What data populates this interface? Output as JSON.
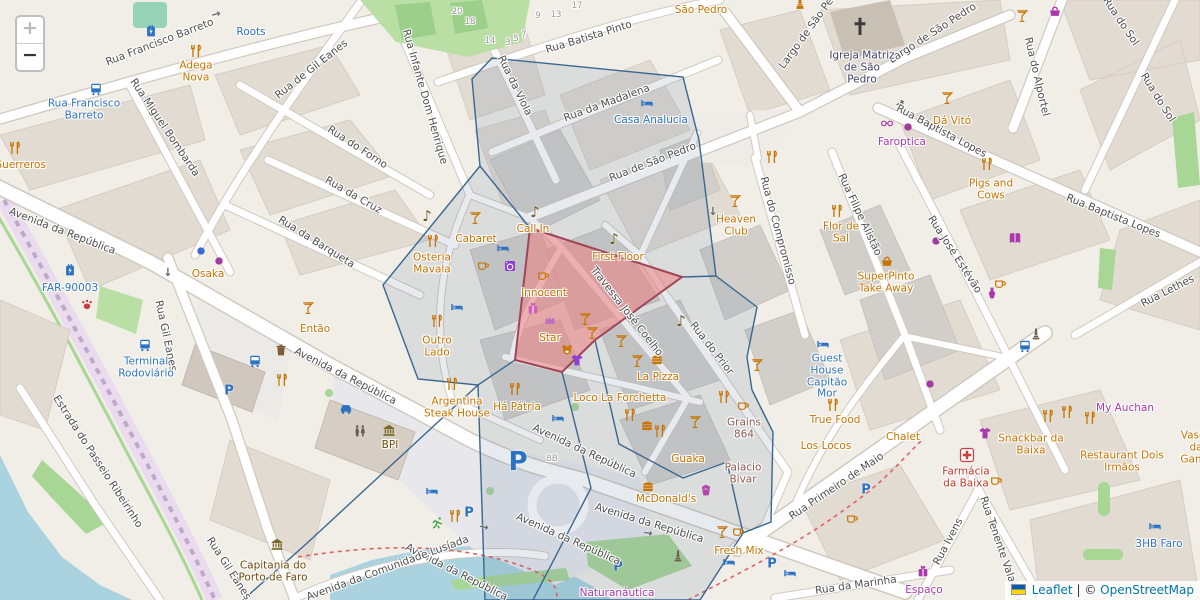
{
  "map": {
    "zoom_control": {
      "zoom_in": "+",
      "zoom_out": "−"
    },
    "attribution": {
      "leaflet_link": "Leaflet",
      "separator": "|",
      "copyright_prefix": "©",
      "osm_link": "OpenStreetMap"
    }
  },
  "palette": {
    "restaurant": "#c77400",
    "shop": "#ac39ac",
    "transit": "#3073c0",
    "brown": "#734a08",
    "historic": "#8d5b52",
    "pharmacy": "#c0392b",
    "church": "#3f3f63",
    "street": "#4e4e4e",
    "overlay_stroke": "#39678f",
    "red_zone_stroke": "#a04458",
    "water": "#aad3df"
  },
  "street_labels": [
    {
      "t": "Rua Francisco Barreto",
      "x": 160,
      "y": 43,
      "r": -21
    },
    {
      "t": "Rua Miguel Bombarda",
      "x": 164,
      "y": 128,
      "r": 56
    },
    {
      "t": "Rua Infante Dom Henrique",
      "x": 424,
      "y": 97,
      "r": 74
    },
    {
      "t": "Rua de Gil Eanes",
      "x": 312,
      "y": 70,
      "r": -38
    },
    {
      "t": "Rua do Forno",
      "x": 357,
      "y": 148,
      "r": 33
    },
    {
      "t": "Rua da Cruz",
      "x": 353,
      "y": 196,
      "r": 30
    },
    {
      "t": "Rua da Barqueta",
      "x": 316,
      "y": 243,
      "r": 32
    },
    {
      "t": "Avenida da República",
      "x": 62,
      "y": 232,
      "r": 21
    },
    {
      "t": "Rua Gil Eanes",
      "x": 165,
      "y": 336,
      "r": 78
    },
    {
      "t": "Rua Gil Eanes",
      "x": 228,
      "y": 569,
      "r": 57
    },
    {
      "t": "Estrada do Passeio Ribeirinho",
      "x": 97,
      "y": 462,
      "r": 57
    },
    {
      "t": "Rua da Viola",
      "x": 514,
      "y": 86,
      "r": 64
    },
    {
      "t": "Rua Batista Pinto",
      "x": 589,
      "y": 38,
      "r": -17
    },
    {
      "t": "Rua da Madalena",
      "x": 607,
      "y": 104,
      "r": -20
    },
    {
      "t": "Rua de São Pedro",
      "x": 653,
      "y": 163,
      "r": -21
    },
    {
      "t": "Largo de São Pedro",
      "x": 812,
      "y": 27,
      "r": -54
    },
    {
      "t": "Largo de São Pedro",
      "x": 933,
      "y": 34,
      "r": -33
    },
    {
      "t": "Rua do Alportel",
      "x": 1036,
      "y": 77,
      "r": 77
    },
    {
      "t": "Rua do Sol",
      "x": 1120,
      "y": 22,
      "r": 56
    },
    {
      "t": "Rua do Sol",
      "x": 1157,
      "y": 98,
      "r": 58
    },
    {
      "t": "Rua Baptista Lopes",
      "x": 941,
      "y": 132,
      "r": 28
    },
    {
      "t": "Rua Baptista Lopes",
      "x": 1113,
      "y": 217,
      "r": 22
    },
    {
      "t": "Rua José Estévão",
      "x": 954,
      "y": 255,
      "r": 57
    },
    {
      "t": "Rua Filipe Alistão",
      "x": 859,
      "y": 215,
      "r": 65
    },
    {
      "t": "Rua do Compromisso",
      "x": 777,
      "y": 231,
      "r": 75
    },
    {
      "t": "Rua do Prior",
      "x": 711,
      "y": 349,
      "r": 52
    },
    {
      "t": "Travessa José Coelho",
      "x": 626,
      "y": 312,
      "r": 52
    },
    {
      "t": "Rua Lethes",
      "x": 1168,
      "y": 292,
      "r": -27
    },
    {
      "t": "Avenida da República",
      "x": 345,
      "y": 377,
      "r": 27
    },
    {
      "t": "Avenida da República",
      "x": 584,
      "y": 452,
      "r": 25
    },
    {
      "t": "Avenida da República",
      "x": 568,
      "y": 540,
      "r": 24
    },
    {
      "t": "Avenida da República",
      "x": 649,
      "y": 524,
      "r": 17
    },
    {
      "t": "Avenida da República",
      "x": 456,
      "y": 573,
      "r": 27
    },
    {
      "t": "Avenida da Comunidade Lusíada",
      "x": 388,
      "y": 569,
      "r": -20
    },
    {
      "t": "Rua Primeiro de Maio",
      "x": 837,
      "y": 487,
      "r": -34
    },
    {
      "t": "Rua da Marinha",
      "x": 856,
      "y": 586,
      "r": -8
    },
    {
      "t": "Rua Ivens",
      "x": 949,
      "y": 542,
      "r": -62
    },
    {
      "t": "Rua Tenente Valadim",
      "x": 1000,
      "y": 549,
      "r": 71
    },
    {
      "t": "8B",
      "x": 552,
      "y": 459,
      "r": 0,
      "ref": true
    }
  ],
  "house_numbers": [
    {
      "t": "20",
      "x": 457,
      "y": 13
    },
    {
      "t": "18",
      "x": 470,
      "y": 23
    },
    {
      "t": "14",
      "x": 490,
      "y": 42
    },
    {
      "t": "3",
      "x": 508,
      "y": 44
    },
    {
      "t": "5",
      "x": 516,
      "y": 40
    },
    {
      "t": "7",
      "x": 524,
      "y": 36
    },
    {
      "t": "9",
      "x": 538,
      "y": 17
    },
    {
      "t": "13",
      "x": 556,
      "y": 16
    },
    {
      "t": "17",
      "x": 577,
      "y": 7
    }
  ],
  "poi_labels": [
    {
      "t": "Roots",
      "x": 251,
      "y": 33,
      "c": "transit"
    },
    {
      "t": "Adega Nova",
      "x": 196,
      "y": 72,
      "c": "restaurant",
      "w": 48
    },
    {
      "t": "Guerreros",
      "x": 20,
      "y": 166,
      "c": "restaurant"
    },
    {
      "t": "Rua Francisco Barreto",
      "x": 84,
      "y": 110,
      "c": "transit",
      "w": 90
    },
    {
      "t": "Osaka",
      "x": 208,
      "y": 275,
      "c": "restaurant"
    },
    {
      "t": "FAR-90003",
      "x": 70,
      "y": 289,
      "c": "transit"
    },
    {
      "t": "Terminal Rodoviário",
      "x": 146,
      "y": 368,
      "c": "transit",
      "w": 68
    },
    {
      "t": "Casa Analucia",
      "x": 651,
      "y": 121,
      "c": "transit"
    },
    {
      "t": "São Pedro",
      "x": 701,
      "y": 11,
      "c": "restaurant"
    },
    {
      "t": "Igreja Matriz de São Pedro",
      "x": 862,
      "y": 68,
      "c": "church",
      "w": 68
    },
    {
      "t": "Dá Vitó",
      "x": 952,
      "y": 122,
      "c": "restaurant"
    },
    {
      "t": "Faroptica",
      "x": 902,
      "y": 143,
      "c": "shop"
    },
    {
      "t": "Pigs and Cows",
      "x": 991,
      "y": 190,
      "c": "restaurant",
      "w": 60
    },
    {
      "t": "Cabaret",
      "x": 476,
      "y": 240,
      "c": "restaurant"
    },
    {
      "t": "Osteria Mavala",
      "x": 432,
      "y": 264,
      "c": "restaurant",
      "w": 54
    },
    {
      "t": "Outro Lado",
      "x": 437,
      "y": 347,
      "c": "restaurant",
      "w": 42
    },
    {
      "t": "Então",
      "x": 315,
      "y": 330,
      "c": "restaurant"
    },
    {
      "t": "Call In",
      "x": 533,
      "y": 230,
      "c": "restaurant"
    },
    {
      "t": "First Floor",
      "x": 618,
      "y": 258,
      "c": "restaurant"
    },
    {
      "t": "Innocent",
      "x": 544,
      "y": 294,
      "c": "restaurant"
    },
    {
      "t": "Star",
      "x": 550,
      "y": 339,
      "c": "restaurant"
    },
    {
      "t": "Heaven Club",
      "x": 736,
      "y": 226,
      "c": "restaurant",
      "w": 50
    },
    {
      "t": "Flor de Sal",
      "x": 841,
      "y": 233,
      "c": "restaurant",
      "w": 42
    },
    {
      "t": "SuperPinto Take Away",
      "x": 886,
      "y": 283,
      "c": "restaurant",
      "w": 82
    },
    {
      "t": "Guest House Capitão Mor",
      "x": 827,
      "y": 377,
      "c": "transit",
      "w": 56
    },
    {
      "t": "La Pizza",
      "x": 658,
      "y": 378,
      "c": "restaurant"
    },
    {
      "t": "Loco La Forchetta",
      "x": 620,
      "y": 399,
      "c": "restaurant"
    },
    {
      "t": "Há Pátria",
      "x": 517,
      "y": 408,
      "c": "restaurant"
    },
    {
      "t": "Argentina Steak House",
      "x": 457,
      "y": 408,
      "c": "restaurant",
      "w": 80
    },
    {
      "t": "True Food",
      "x": 835,
      "y": 421,
      "c": "restaurant"
    },
    {
      "t": "Los Locos",
      "x": 826,
      "y": 447,
      "c": "restaurant"
    },
    {
      "t": "Chalet",
      "x": 903,
      "y": 438,
      "c": "restaurant"
    },
    {
      "t": "Grains 864",
      "x": 744,
      "y": 429,
      "c": "historic",
      "w": 44
    },
    {
      "t": "Guaka",
      "x": 688,
      "y": 460,
      "c": "restaurant"
    },
    {
      "t": "Palacio Bivar",
      "x": 743,
      "y": 474,
      "c": "historic",
      "w": 52
    },
    {
      "t": "McDonald's",
      "x": 666,
      "y": 500,
      "c": "restaurant"
    },
    {
      "t": "Fresh Mix",
      "x": 739,
      "y": 552,
      "c": "restaurant"
    },
    {
      "t": "BPI",
      "x": 390,
      "y": 446,
      "c": "brown"
    },
    {
      "t": "Capitania do Porto de Faro",
      "x": 273,
      "y": 572,
      "c": "brown",
      "w": 74
    },
    {
      "t": "Naturanáutica",
      "x": 617,
      "y": 594,
      "c": "shop"
    },
    {
      "t": "My Auchan",
      "x": 1125,
      "y": 409,
      "c": "shop"
    },
    {
      "t": "Snackbar da Baixa",
      "x": 1031,
      "y": 445,
      "c": "restaurant",
      "w": 68
    },
    {
      "t": "Restaurant Dois Irmãos",
      "x": 1122,
      "y": 462,
      "c": "restaurant",
      "w": 105
    },
    {
      "t": "Farmácia da Baixa",
      "x": 966,
      "y": 478,
      "c": "pharmacy",
      "w": 62
    },
    {
      "t": "Espaço",
      "x": 924,
      "y": 591,
      "c": "shop"
    },
    {
      "t": "Vasco da Gama",
      "x": 1196,
      "y": 448,
      "c": "restaurant",
      "w": 46
    },
    {
      "t": "3HB Faro",
      "x": 1159,
      "y": 545,
      "c": "transit"
    }
  ],
  "icons": [
    {
      "k": "charge",
      "x": 151,
      "y": 32,
      "c": "#2b72c2"
    },
    {
      "k": "charge",
      "x": 70,
      "y": 271,
      "c": "#2b72c2"
    },
    {
      "k": "bus",
      "x": 96,
      "y": 90,
      "c": "#2b72c2"
    },
    {
      "k": "bus",
      "x": 145,
      "y": 346,
      "c": "#2b72c2"
    },
    {
      "k": "bus",
      "x": 255,
      "y": 362,
      "c": "#2b72c2"
    },
    {
      "k": "bus",
      "x": 1025,
      "y": 347,
      "c": "#2b72c2"
    },
    {
      "k": "pletter",
      "x": 229,
      "y": 391,
      "c": "#2b72c2"
    },
    {
      "k": "pletter",
      "x": 518,
      "y": 462,
      "c": "#2b72c2",
      "s": 26
    },
    {
      "k": "pletter",
      "x": 618,
      "y": 567,
      "c": "#2b72c2"
    },
    {
      "k": "pletter",
      "x": 772,
      "y": 564,
      "c": "#2b72c2"
    },
    {
      "k": "pletter",
      "x": 866,
      "y": 490,
      "c": "#2b72c2"
    },
    {
      "k": "pletter",
      "x": 469,
      "y": 513,
      "c": "#2b72c2"
    },
    {
      "k": "car",
      "x": 346,
      "y": 410,
      "c": "#2b72c2"
    },
    {
      "k": "paw",
      "x": 87,
      "y": 306,
      "c": "#cc3b3b"
    },
    {
      "k": "cross",
      "x": 860,
      "y": 28,
      "c": "#3a3a3a",
      "s": 18
    },
    {
      "k": "pharm",
      "x": 967,
      "y": 457,
      "c": "#d33d3d",
      "s": 15
    },
    {
      "k": "statue",
      "x": 800,
      "y": 4,
      "c": "#c77400"
    },
    {
      "k": "monument",
      "x": 1036,
      "y": 335,
      "c": "#6e5f4e"
    },
    {
      "k": "monument",
      "x": 678,
      "y": 557,
      "c": "#6e5f4e"
    },
    {
      "k": "bank",
      "x": 389,
      "y": 431,
      "c": "#7a6a28"
    },
    {
      "k": "bank",
      "x": 277,
      "y": 545,
      "c": "#7a6a28"
    },
    {
      "k": "toilet",
      "x": 360,
      "y": 432,
      "c": "#6b5d4f"
    },
    {
      "k": "trash",
      "x": 281,
      "y": 351,
      "c": "#7a5b3a"
    },
    {
      "k": "runner",
      "x": 438,
      "y": 524,
      "c": "#3aa33a"
    },
    {
      "k": "fork",
      "x": 196,
      "y": 52
    },
    {
      "k": "fork",
      "x": 15,
      "y": 149
    },
    {
      "k": "fork",
      "x": 433,
      "y": 242
    },
    {
      "k": "fork",
      "x": 437,
      "y": 322
    },
    {
      "k": "fork",
      "x": 515,
      "y": 390
    },
    {
      "k": "fork",
      "x": 837,
      "y": 212
    },
    {
      "k": "fork",
      "x": 987,
      "y": 165
    },
    {
      "k": "fork",
      "x": 833,
      "y": 406
    },
    {
      "k": "fork",
      "x": 772,
      "y": 158
    },
    {
      "k": "fork",
      "x": 724,
      "y": 398
    },
    {
      "k": "fork",
      "x": 660,
      "y": 432
    },
    {
      "k": "fork",
      "x": 1048,
      "y": 417
    },
    {
      "k": "fork",
      "x": 1067,
      "y": 413
    },
    {
      "k": "fork",
      "x": 1090,
      "y": 419
    },
    {
      "k": "fork",
      "x": 455,
      "y": 517
    },
    {
      "k": "fork",
      "x": 452,
      "y": 385
    },
    {
      "k": "fork",
      "x": 282,
      "y": 381
    },
    {
      "k": "fork",
      "x": 630,
      "y": 416
    },
    {
      "k": "cocktail",
      "x": 475,
      "y": 219
    },
    {
      "k": "cocktail",
      "x": 735,
      "y": 202
    },
    {
      "k": "cocktail",
      "x": 308,
      "y": 309
    },
    {
      "k": "cocktail",
      "x": 1022,
      "y": 17
    },
    {
      "k": "cocktail",
      "x": 621,
      "y": 342
    },
    {
      "k": "cocktail",
      "x": 637,
      "y": 362
    },
    {
      "k": "cocktail",
      "x": 695,
      "y": 423
    },
    {
      "k": "cocktail",
      "x": 722,
      "y": 533
    },
    {
      "k": "cocktail",
      "x": 585,
      "y": 320
    },
    {
      "k": "cocktail",
      "x": 592,
      "y": 334
    },
    {
      "k": "cocktail",
      "x": 757,
      "y": 366
    },
    {
      "k": "cocktail",
      "x": 947,
      "y": 99
    },
    {
      "k": "cup",
      "x": 483,
      "y": 266
    },
    {
      "k": "cup",
      "x": 1000,
      "y": 284
    },
    {
      "k": "cup",
      "x": 996,
      "y": 481
    },
    {
      "k": "cup",
      "x": 852,
      "y": 519
    },
    {
      "k": "cup",
      "x": 743,
      "y": 406
    },
    {
      "k": "cup",
      "x": 1145,
      "y": 589
    },
    {
      "k": "cup",
      "x": 738,
      "y": 532
    },
    {
      "k": "cup",
      "x": 543,
      "y": 276
    },
    {
      "k": "note",
      "x": 427,
      "y": 216,
      "c": "#6b5a1e"
    },
    {
      "k": "note",
      "x": 535,
      "y": 212,
      "c": "#6b5a1e"
    },
    {
      "k": "note",
      "x": 614,
      "y": 239,
      "c": "#6b5a1e"
    },
    {
      "k": "note",
      "x": 681,
      "y": 321,
      "c": "#6b5a1e"
    },
    {
      "k": "bed",
      "x": 503,
      "y": 249,
      "c": "#2b72c2"
    },
    {
      "k": "bed",
      "x": 457,
      "y": 308,
      "c": "#2b72c2"
    },
    {
      "k": "bed",
      "x": 647,
      "y": 104,
      "c": "#2b72c2"
    },
    {
      "k": "bed",
      "x": 823,
      "y": 345,
      "c": "#2b72c2"
    },
    {
      "k": "bed",
      "x": 1155,
      "y": 527,
      "c": "#2b72c2"
    },
    {
      "k": "bed",
      "x": 558,
      "y": 419,
      "c": "#2b72c2"
    },
    {
      "k": "bed",
      "x": 432,
      "y": 492,
      "c": "#2b72c2"
    },
    {
      "k": "bed",
      "x": 729,
      "y": 563,
      "c": "#2b72c2"
    },
    {
      "k": "bed",
      "x": 790,
      "y": 574,
      "c": "#2b72c2"
    },
    {
      "k": "gift",
      "x": 533,
      "y": 309,
      "c": "#d45fb8"
    },
    {
      "k": "gift",
      "x": 923,
      "y": 572,
      "c": "#ac39ac"
    },
    {
      "k": "crown",
      "x": 550,
      "y": 321,
      "c": "#c06fc0"
    },
    {
      "k": "bear",
      "x": 567,
      "y": 351,
      "c": "#c77400"
    },
    {
      "k": "tshirt",
      "x": 577,
      "y": 361,
      "c": "#8b3fd4"
    },
    {
      "k": "tshirt",
      "x": 985,
      "y": 434,
      "c": "#ac39ac"
    },
    {
      "k": "dress",
      "x": 992,
      "y": 294,
      "c": "#ac39ac"
    },
    {
      "k": "book",
      "x": 1015,
      "y": 239,
      "c": "#ac39ac"
    },
    {
      "k": "glasses",
      "x": 887,
      "y": 124,
      "c": "#ac39ac"
    },
    {
      "k": "laundry",
      "x": 510,
      "y": 267,
      "c": "#8b3fd4"
    },
    {
      "k": "cake",
      "x": 706,
      "y": 491,
      "c": "#b048b0"
    },
    {
      "k": "bread",
      "x": 887,
      "y": 261
    },
    {
      "k": "bread",
      "x": 1055,
      "y": 11,
      "c": "#ac39ac"
    },
    {
      "k": "burger",
      "x": 647,
      "y": 427
    },
    {
      "k": "burger",
      "x": 648,
      "y": 488
    },
    {
      "k": "burger",
      "x": 657,
      "y": 361
    },
    {
      "k": "dot",
      "x": 201,
      "y": 252,
      "c": "#3b6ad4"
    },
    {
      "k": "dot",
      "x": 219,
      "y": 262,
      "c": "#a03ba0"
    },
    {
      "k": "dot",
      "x": 908,
      "y": 128,
      "c": "#a03ba0"
    },
    {
      "k": "dot",
      "x": 936,
      "y": 242,
      "c": "#a03ba0"
    },
    {
      "k": "dot",
      "x": 930,
      "y": 385,
      "c": "#a03ba0"
    },
    {
      "k": "arrow",
      "x": 216,
      "y": 14,
      "c": "#666",
      "r": -15
    },
    {
      "k": "arrow",
      "x": 168,
      "y": 272,
      "c": "#666",
      "r": 90
    },
    {
      "k": "arrow",
      "x": 484,
      "y": 527,
      "c": "#666",
      "r": 12
    },
    {
      "k": "arrow",
      "x": 648,
      "y": 533,
      "c": "#666",
      "r": 10
    },
    {
      "k": "arrow",
      "x": 900,
      "y": 103,
      "c": "#666",
      "r": -28
    },
    {
      "k": "arrow",
      "x": 713,
      "y": 211,
      "c": "#666",
      "r": 90
    }
  ],
  "overlay": {
    "cells_outline": {
      "points": "492,58 683,77 699,140 716,276 757,307 747,357 752,390 773,432 771,522 743,533 700,600 485,600 478,385 418,379 383,285 480,166 472,79",
      "fill": "rgba(105,130,160,0.16)",
      "stroke": "#39678f"
    },
    "edges": [
      "530,228 480,166",
      "682,277 716,276",
      "595,340 619,444 683,478 727,462 743,533",
      "562,372 591,488 533,600",
      "515,360 478,385",
      "478,385 305,545 243,600"
    ],
    "red_zone": {
      "points": "530,228 682,277 595,340 562,372 515,360",
      "fill": "rgba(238,128,128,0.55)",
      "stroke": "#a04458"
    }
  }
}
